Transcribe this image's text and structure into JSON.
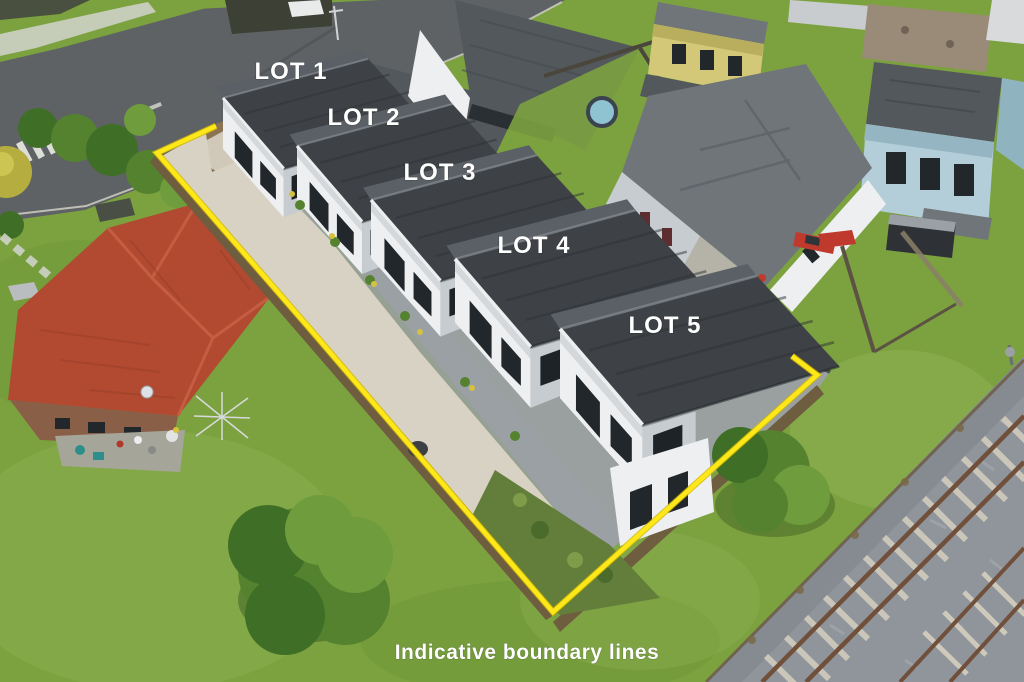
{
  "annotations": {
    "lot_labels": [
      {
        "text": "LOT 1"
      },
      {
        "text": "LOT 2"
      },
      {
        "text": "LOT 3"
      },
      {
        "text": "LOT 4"
      },
      {
        "text": "LOT 5"
      }
    ],
    "caption": "Indicative boundary lines"
  },
  "boundary": {
    "points": "216,126 157,153 310,329 553,612 817,375 792,356",
    "color": "#FFE81A"
  },
  "palette": {
    "grass": "#7CA23F",
    "grass_light": "#92B457",
    "grass_dark": "#5E8A31",
    "road": "#5E6265",
    "concrete": "#D7D2C3",
    "paver": "#9BA0A4",
    "kerb": "#C9C9BF",
    "roof_dark": "#3E4246",
    "wall_white": "#EDEFF0",
    "wall_shade": "#C6CCD0",
    "window": "#22272B",
    "red_roof": "#B14A31",
    "brick": "#8A5F48",
    "deck": "#A6A59A",
    "timber": "#6F5D3F",
    "boundary": "#FFE81A",
    "ballast": "#8F959A",
    "rail": "#70503B",
    "sleeper": "#CFC9BC",
    "neighbor_roof": "#70757A",
    "neighbor_roof_dark": "#53585D",
    "yellow_house": "#D2C878",
    "blue_house": "#B3CED8",
    "tan_roof": "#9A8B79",
    "shed": "#2E3237",
    "pool": "#8FC3D2",
    "red_vehicle": "#BF3A2C",
    "tree": "#54822F",
    "tree_dark": "#3F6E26",
    "tree_light": "#6F9C3D",
    "yellow_bush": "#B5AD3F",
    "fence_wood": "#5C5244",
    "garden": "#637E3B",
    "label_text": "#FFFFFF"
  }
}
